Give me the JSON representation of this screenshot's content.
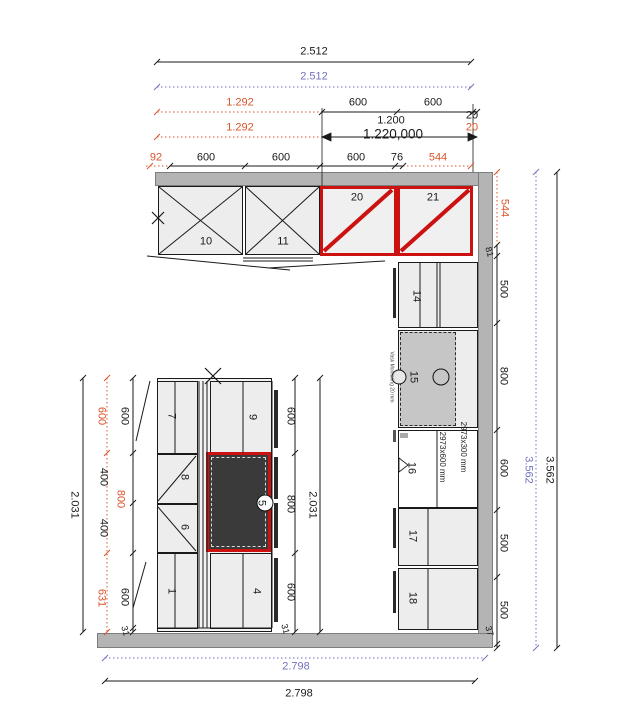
{
  "colors": {
    "red": "#cc1111",
    "orange": "#d9542b",
    "blue": "#7272bd",
    "wall": "#b4b4b4"
  },
  "d": {
    "top": {
      "total": "2.512",
      "total_blue": "2.512",
      "r3_left": "1.292",
      "r3_s1": "600",
      "r3_s2": "600",
      "r3_off": "20",
      "r4_left": "1.292",
      "r4_span": "1.200",
      "r4_span2": "1.220,000",
      "r4_off": "20",
      "r5_s0": "92",
      "r5_s1": "600",
      "r5_s2": "600",
      "r5_s3": "600",
      "r5_s4": "76",
      "r5_s5": "544"
    },
    "right": {
      "off": "544",
      "gap": "81",
      "s1": "500",
      "s2": "800",
      "s3": "600",
      "s4": "500",
      "s5": "500",
      "end": "37",
      "total_blue": "3.562",
      "total": "3.562"
    },
    "left": {
      "total": "2.031",
      "o1": "600",
      "o2": "800",
      "o3": "631",
      "b1": "600",
      "b2": "400",
      "b3": "400",
      "b4": "600",
      "end": "31"
    },
    "mid": {
      "s1": "600",
      "s2": "800",
      "s3": "600",
      "total": "2.031",
      "end": "31"
    },
    "bottom": {
      "total_blue": "2.798",
      "total": "2.798"
    }
  },
  "cab": {
    "c1": "1",
    "c4": "4",
    "c5": "5",
    "c6": "6",
    "c7": "7",
    "c8": "8",
    "c9": "9",
    "c10": "10",
    "c11": "11",
    "c14": "14",
    "c15": "15",
    "c16": "16",
    "c17": "17",
    "c18": "18",
    "c20": "20",
    "c21": "21"
  },
  "notes": {
    "sink": "Vask Montering 20 mm",
    "p300": "2973x300 mm",
    "p600": "2973x600 mm"
  }
}
